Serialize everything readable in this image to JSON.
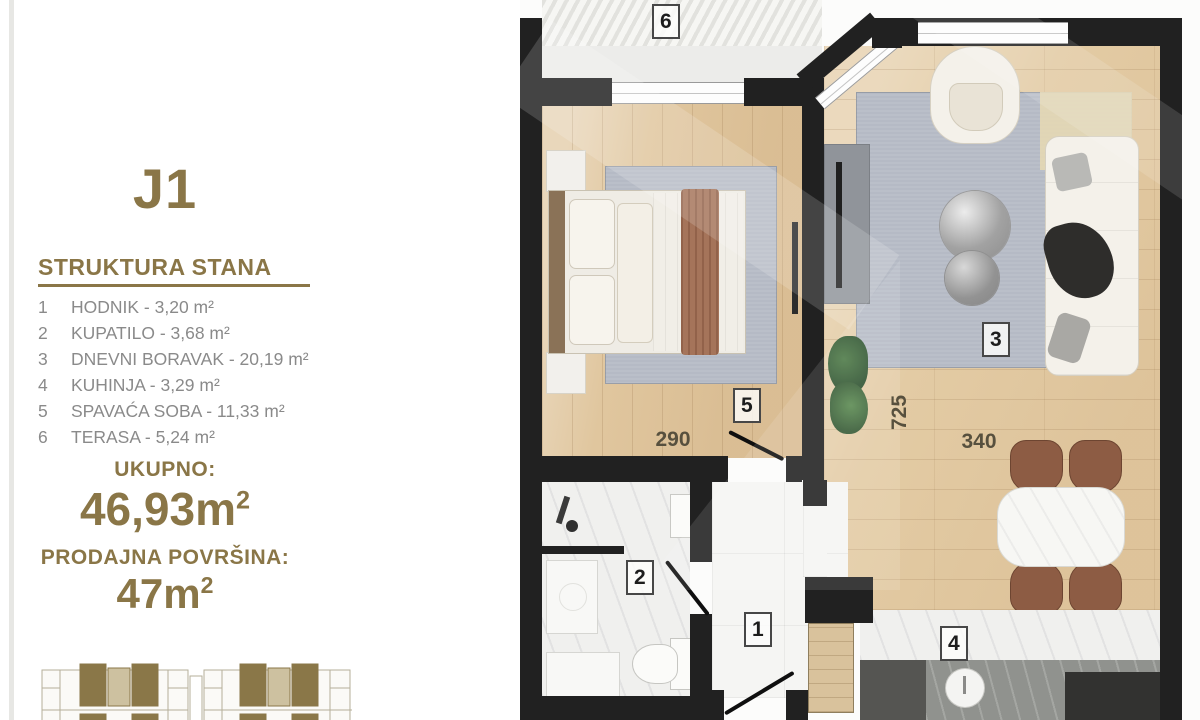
{
  "sidebar": {
    "unit_title": "J1",
    "structure_heading": "STRUKTURA STANA",
    "rooms": [
      {
        "num": "1",
        "label": "HODNIK - 3,20 m²"
      },
      {
        "num": "2",
        "label": "KUPATILO - 3,68 m²"
      },
      {
        "num": "3",
        "label": "DNEVNI BORAVAK - 20,19 m²"
      },
      {
        "num": "4",
        "label": "KUHINJA - 3,29 m²"
      },
      {
        "num": "5",
        "label": "SPAVAĆA SOBA - 11,33 m²"
      },
      {
        "num": "6",
        "label": "TERASA - 5,24 m²"
      }
    ],
    "total_label": "UKUPNO:",
    "total_value": "46,93m",
    "total_sup": "2",
    "sale_label": "PRODAJNA POVRŠINA:",
    "sale_value": "47m",
    "sale_sup": "2"
  },
  "plan": {
    "labels": {
      "hallway": "1",
      "bathroom": "2",
      "living_room": "3",
      "kitchen": "4",
      "bedroom": "5",
      "terrace": "6"
    },
    "dimensions": {
      "bedroom_width": "290",
      "living_length": "725",
      "living_width": "340"
    }
  },
  "colors": {
    "accent_gold": "#8a7647",
    "list_gray": "#8a8a8a",
    "wall_black": "#212121"
  }
}
